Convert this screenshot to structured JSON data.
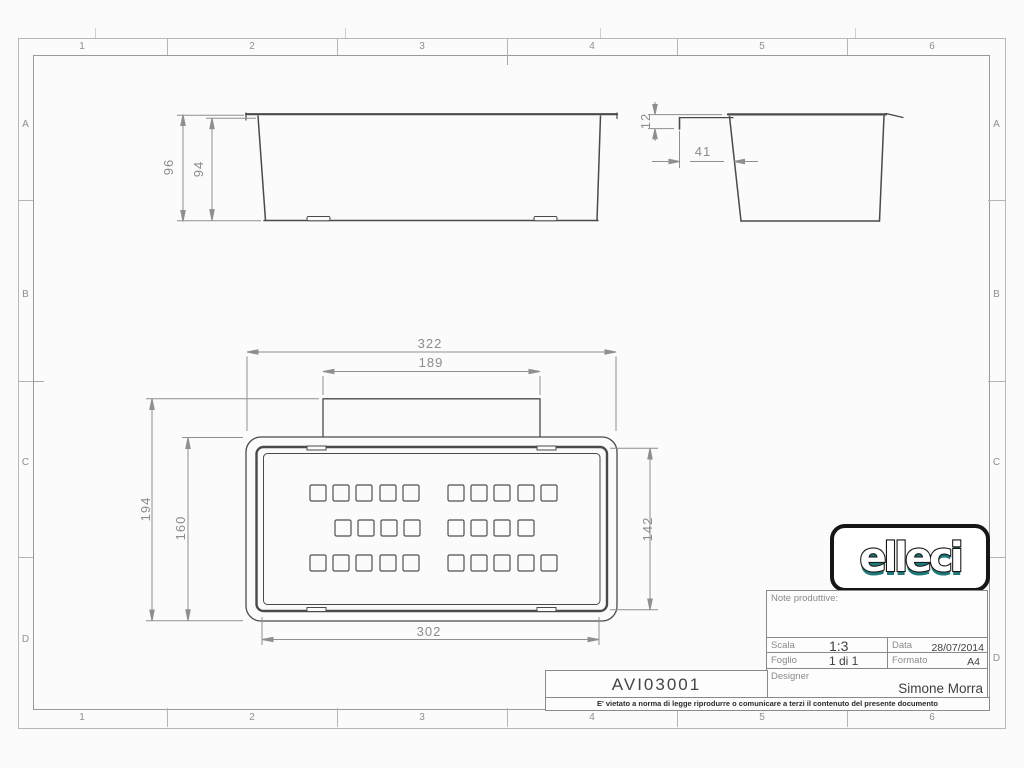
{
  "sheet": {
    "zone_columns": [
      "1",
      "2",
      "3",
      "4",
      "5",
      "6"
    ],
    "zone_rows": [
      "A",
      "B",
      "C",
      "D"
    ]
  },
  "views": {
    "front": {
      "dims": {
        "outer_height": "96",
        "inner_height": "94"
      }
    },
    "side": {
      "dims": {
        "lip_height": "12",
        "lip_offset": "41"
      }
    },
    "top": {
      "dims": {
        "overall_width": "322",
        "tab_width": "189",
        "overall_depth": "194",
        "body_depth": "160",
        "inner_depth": "142",
        "inner_width": "302"
      },
      "holes": {
        "size": 16,
        "rows": [
          {
            "y": 485,
            "x": [
              310,
              333,
              356,
              380,
              403,
              448,
              471,
              494,
              518,
              541
            ]
          },
          {
            "y": 520,
            "x": [
              335,
              358,
              381,
              404,
              448,
              471,
              494,
              518
            ]
          },
          {
            "y": 555,
            "x": [
              310,
              333,
              356,
              380,
              403,
              448,
              471,
              494,
              518,
              541
            ]
          }
        ]
      }
    }
  },
  "title_block": {
    "logo_text": "elleci",
    "note_label": "Note produttive:",
    "scala_label": "Scala",
    "scala_value": "1:3",
    "data_label": "Data",
    "data_value": "28/07/2014",
    "foglio_label": "Foglio",
    "foglio_value": "1 di 1",
    "formato_label": "Formato",
    "formato_value": "A4",
    "designer_label": "Designer",
    "designer_value": "Simone Morra",
    "part_number": "AVI03001",
    "disclaimer": "E' vietato a norma di legge riprodurre o comunicare a terzi il contenuto del presente documento"
  },
  "colors": {
    "object_line": "#4a4a4a",
    "dim_line": "#8f8f8f",
    "logo_teal": "#1d7a7a",
    "frame": "#9a9a9a"
  }
}
